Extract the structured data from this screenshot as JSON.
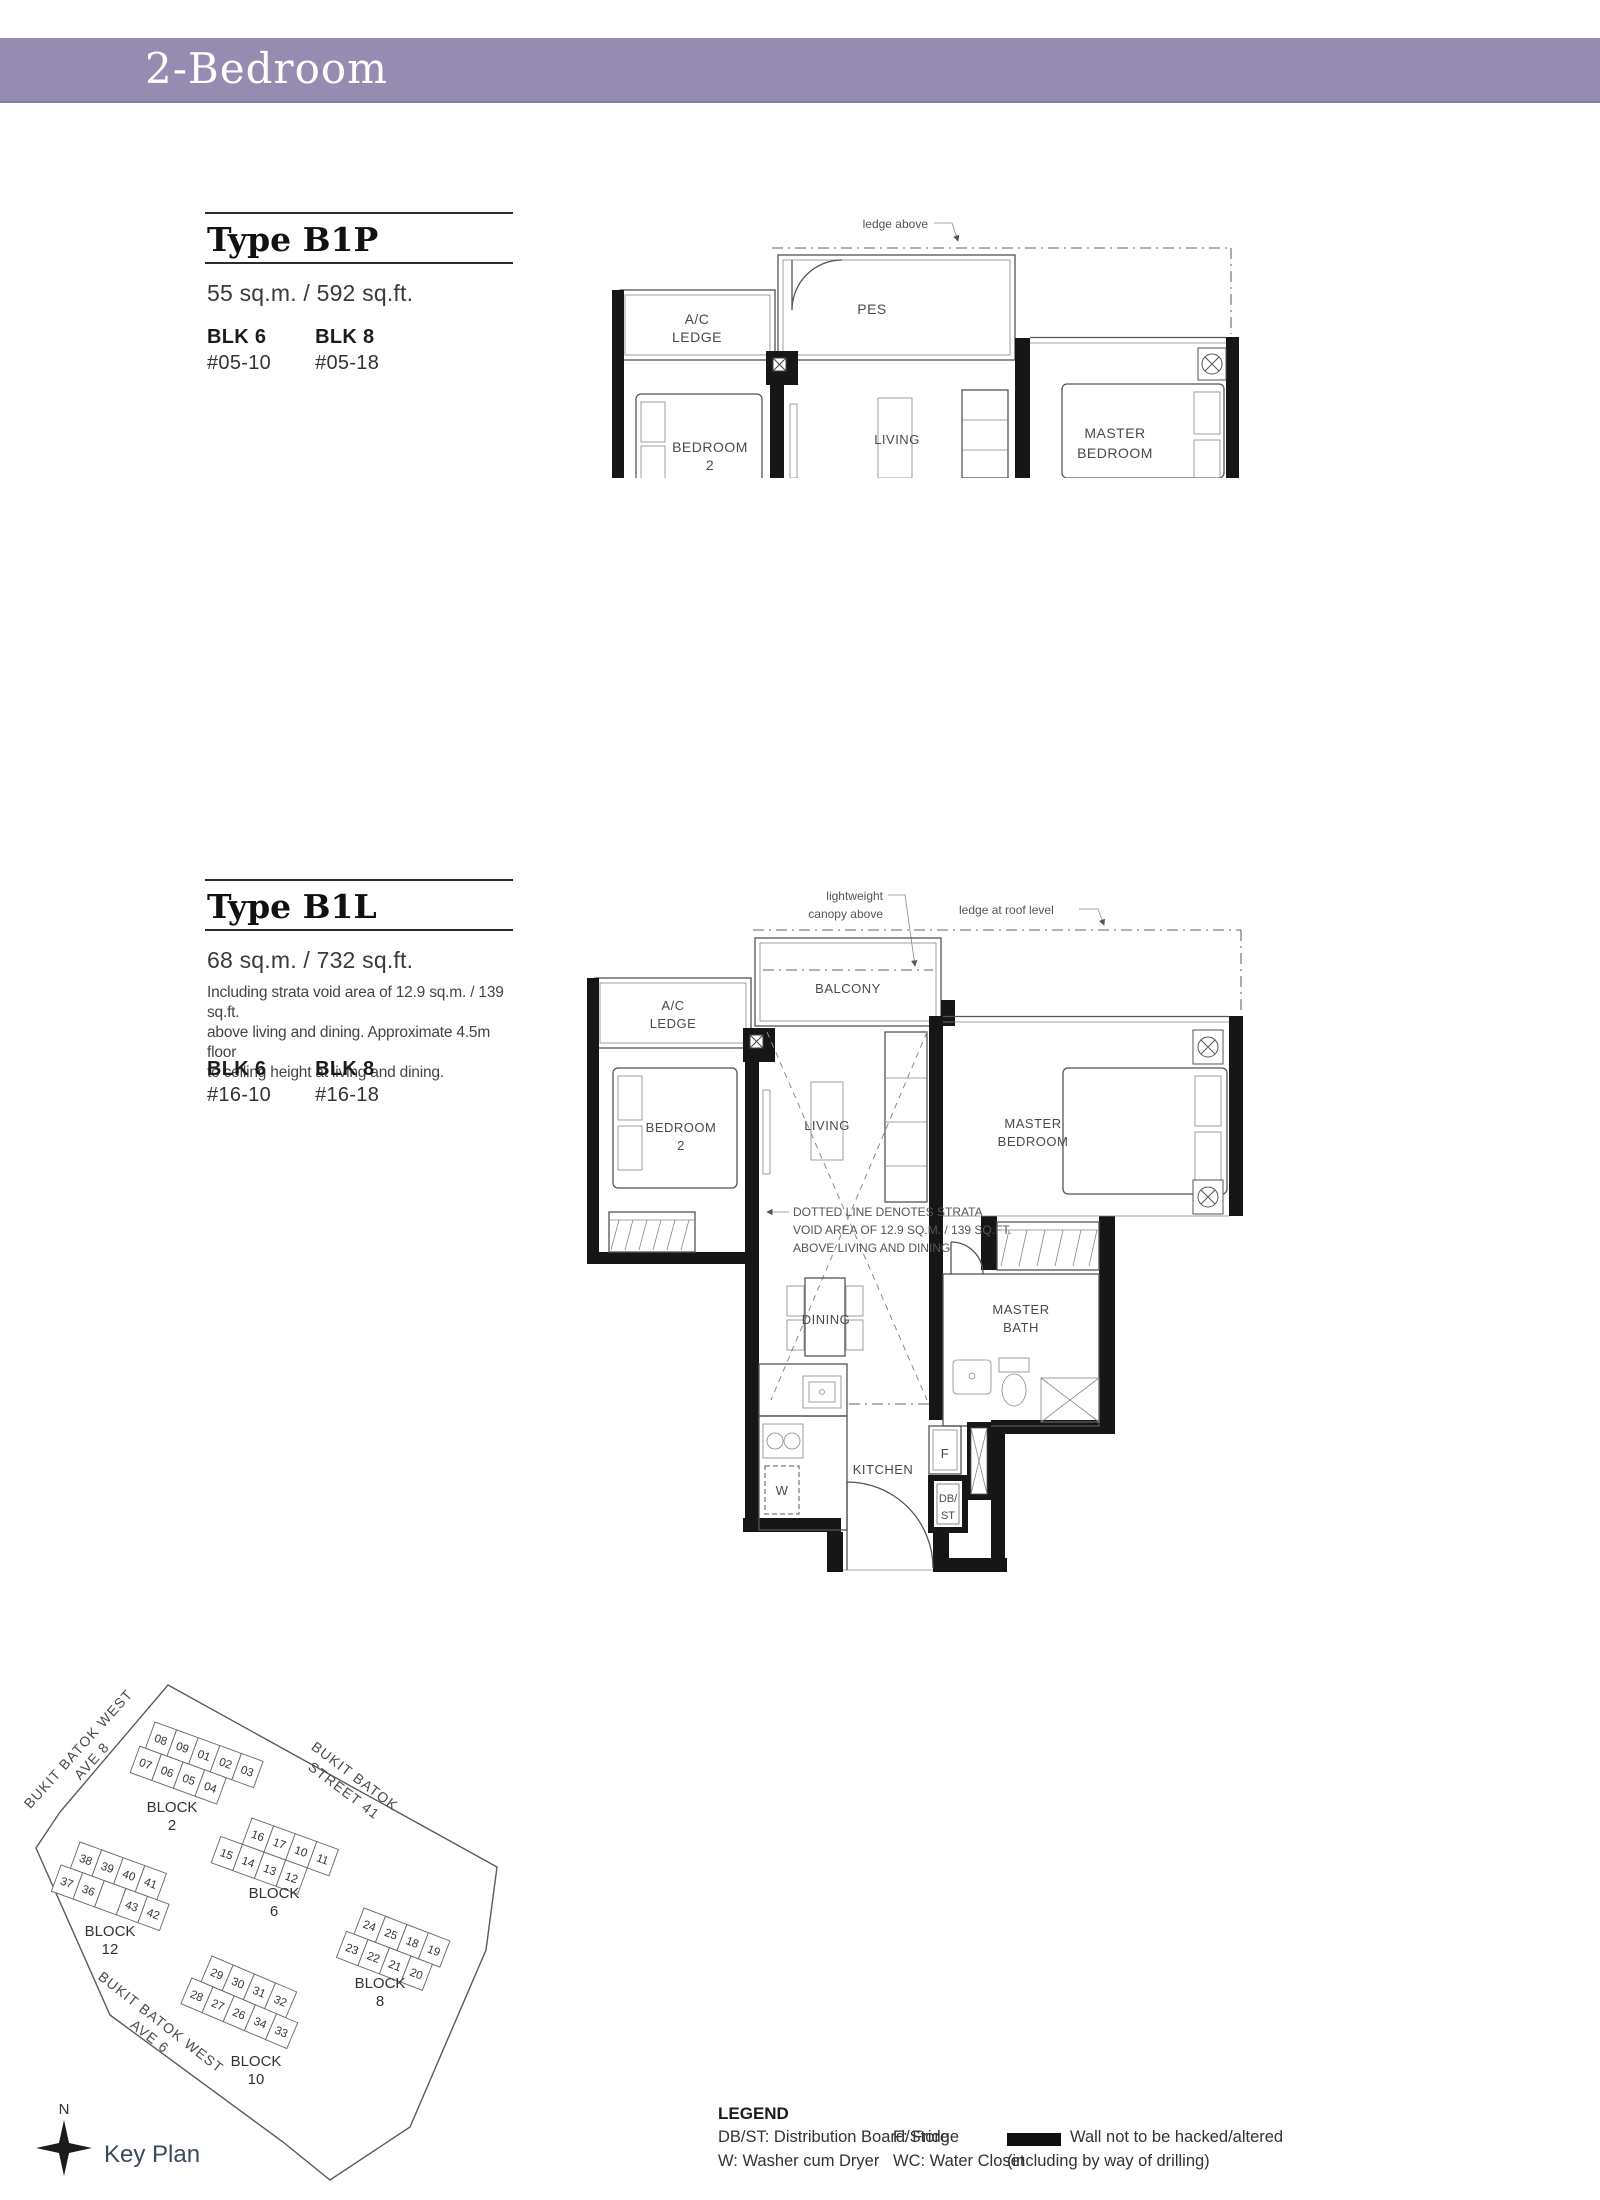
{
  "banner": {
    "title": "2-Bedroom",
    "bg_color": "#968bb1"
  },
  "b1p": {
    "type": "Type B1P",
    "area": "55 sq.m. / 592 sq.ft.",
    "stacks": [
      {
        "blk": "BLK 6",
        "unit": "#05-10"
      },
      {
        "blk": "BLK 8",
        "unit": "#05-18"
      }
    ],
    "plan": {
      "ledge_above": "ledge above",
      "pes": "PES",
      "ac1": "A/C",
      "ac2": "LEDGE",
      "bed2a": "BEDROOM",
      "bed2b": "2",
      "living": "LIVING",
      "master1": "MASTER",
      "master2": "BEDROOM"
    }
  },
  "b1l": {
    "type": "Type B1L",
    "area": "68 sq.m. / 732 sq.ft.",
    "note1": "Including strata void area of 12.9 sq.m. / 139 sq.ft.",
    "note2": "above living and dining. Approximate 4.5m floor",
    "note3": "to ceiling height at living and dining.",
    "stacks": [
      {
        "blk": "BLK 6",
        "unit": "#16-10"
      },
      {
        "blk": "BLK 8",
        "unit": "#16-18"
      }
    ],
    "plan": {
      "canopy1": "lightweight",
      "canopy2": "canopy above",
      "roof_ledge": "ledge at roof level",
      "balcony": "BALCONY",
      "ac1": "A/C",
      "ac2": "LEDGE",
      "bed2a": "BEDROOM",
      "bed2b": "2",
      "living": "LIVING",
      "master1": "MASTER",
      "master2": "BEDROOM",
      "void1": "DOTTED LINE DENOTES STRATA",
      "void2": "VOID AREA OF 12.9 SQ.M. / 139 SQ.FT.",
      "void3": "ABOVE LIVING AND DINING",
      "dining": "DINING",
      "kitchen": "KITCHEN",
      "bath1": "MASTER",
      "bath2": "BATH",
      "w": "W",
      "f": "F",
      "db": "DB/",
      "st": "ST"
    }
  },
  "keyplan": {
    "title": "Key Plan",
    "north": "N",
    "highlight_color": "#9d8bb9",
    "streets": [
      {
        "l1": "BUKIT BATOK WEST",
        "l2": "AVE 8"
      },
      {
        "l1": "BUKIT BATOK",
        "l2": "STREET 41"
      },
      {
        "l1": "BUKIT BATOK WEST",
        "l2": "AVE 6"
      }
    ],
    "blocks": [
      {
        "label1": "BLOCK",
        "label2": "2",
        "row1": [
          "08",
          "09",
          "01",
          "02",
          "03"
        ],
        "row2": [
          "07",
          "06",
          "05",
          "04"
        ]
      },
      {
        "label1": "BLOCK",
        "label2": "6",
        "row1": [
          "16",
          "17",
          "10",
          "11"
        ],
        "row2": [
          "15",
          "14",
          "13",
          "12"
        ]
      },
      {
        "label1": "BLOCK",
        "label2": "12",
        "row1": [
          "38",
          "39",
          "40",
          "41"
        ],
        "row2": [
          "37",
          "36",
          "35",
          "43",
          "42"
        ]
      },
      {
        "label1": "BLOCK",
        "label2": "8",
        "row1": [
          "24",
          "25",
          "18",
          "19"
        ],
        "row2": [
          "23",
          "22",
          "21",
          "20"
        ]
      },
      {
        "label1": "BLOCK",
        "label2": "10",
        "row1": [
          "29",
          "30",
          "31",
          "32"
        ],
        "row2": [
          "28",
          "27",
          "26",
          "34",
          "33"
        ]
      }
    ]
  },
  "legend": {
    "title": "LEGEND",
    "items_col1": [
      "DB/ST: Distribution Board/Store",
      "W: Washer cum Dryer"
    ],
    "items_col2": [
      "F: Fridge",
      "WC: Water Closet"
    ],
    "wall1": "Wall not to be hacked/altered",
    "wall2": "(including by way of drilling)"
  }
}
